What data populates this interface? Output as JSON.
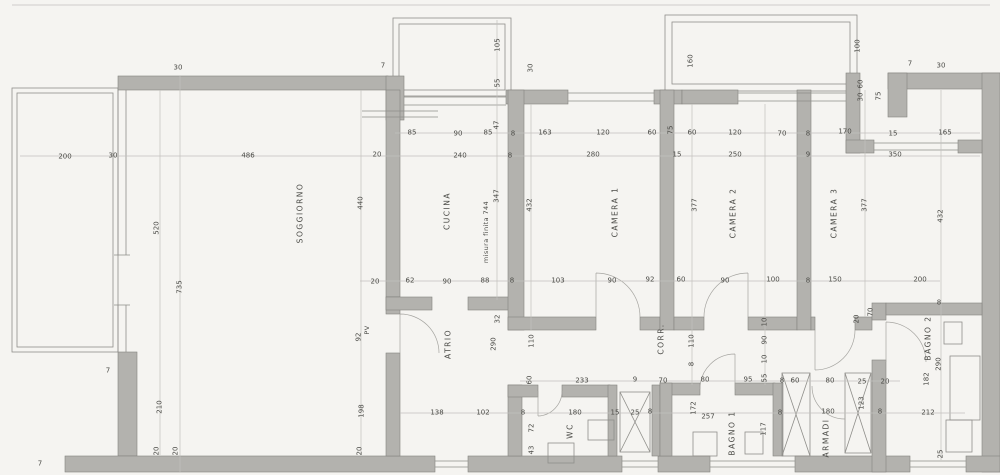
{
  "colors": {
    "paper": "#f5f4f1",
    "wall": "#b3b2ae",
    "line": "#8f8e8a",
    "thin": "#c2c1bd",
    "text": "#4b4b47"
  },
  "rooms": [
    {
      "t": "SOGGIORNO",
      "x": 300,
      "y": 213,
      "r": 1
    },
    {
      "t": "CUCINA",
      "x": 447,
      "y": 211,
      "r": 1
    },
    {
      "t": "CAMERA 1",
      "x": 615,
      "y": 212,
      "r": 1
    },
    {
      "t": "CAMERA 2",
      "x": 733,
      "y": 213,
      "r": 1
    },
    {
      "t": "CAMERA 3",
      "x": 834,
      "y": 213,
      "r": 1
    },
    {
      "t": "ATRIO",
      "x": 448,
      "y": 344,
      "r": 1
    },
    {
      "t": "CORR.",
      "x": 661,
      "y": 339,
      "r": 1
    },
    {
      "t": "WC",
      "x": 570,
      "y": 431,
      "r": 1
    },
    {
      "t": "BAGNO 1",
      "x": 732,
      "y": 433,
      "r": 1
    },
    {
      "t": "ARMADI",
      "x": 826,
      "y": 438,
      "r": 1
    },
    {
      "t": "BAGNO 2",
      "x": 928,
      "y": 338,
      "r": 1
    }
  ],
  "dimensions": [
    {
      "t": "30",
      "x": 178,
      "y": 68
    },
    {
      "t": "7",
      "x": 383,
      "y": 66
    },
    {
      "t": "105",
      "x": 498,
      "y": 45,
      "r": 1
    },
    {
      "t": "55",
      "x": 498,
      "y": 83,
      "r": 1
    },
    {
      "t": "30",
      "x": 531,
      "y": 68,
      "r": 1
    },
    {
      "t": "160",
      "x": 691,
      "y": 61,
      "r": 1
    },
    {
      "t": "100",
      "x": 858,
      "y": 46,
      "r": 1
    },
    {
      "t": "60",
      "x": 861,
      "y": 84,
      "r": 1
    },
    {
      "t": "30",
      "x": 861,
      "y": 97,
      "r": 1
    },
    {
      "t": "75",
      "x": 879,
      "y": 96,
      "r": 1
    },
    {
      "t": "7",
      "x": 910,
      "y": 64
    },
    {
      "t": "30",
      "x": 941,
      "y": 66
    },
    {
      "t": "85",
      "x": 412,
      "y": 133
    },
    {
      "t": "90",
      "x": 458,
      "y": 134
    },
    {
      "t": "85",
      "x": 488,
      "y": 133
    },
    {
      "t": "47",
      "x": 497,
      "y": 125,
      "r": 1
    },
    {
      "t": "8",
      "x": 513,
      "y": 134
    },
    {
      "t": "163",
      "x": 545,
      "y": 133
    },
    {
      "t": "120",
      "x": 603,
      "y": 133
    },
    {
      "t": "60",
      "x": 652,
      "y": 133
    },
    {
      "t": "75",
      "x": 671,
      "y": 130,
      "r": 1
    },
    {
      "t": "60",
      "x": 692,
      "y": 133
    },
    {
      "t": "120",
      "x": 735,
      "y": 133
    },
    {
      "t": "70",
      "x": 782,
      "y": 134
    },
    {
      "t": "8",
      "x": 808,
      "y": 134
    },
    {
      "t": "170",
      "x": 845,
      "y": 132
    },
    {
      "t": "15",
      "x": 893,
      "y": 134
    },
    {
      "t": "165",
      "x": 945,
      "y": 133
    },
    {
      "t": "200",
      "x": 65,
      "y": 157
    },
    {
      "t": "30",
      "x": 113,
      "y": 156
    },
    {
      "t": "486",
      "x": 248,
      "y": 156
    },
    {
      "t": "20",
      "x": 377,
      "y": 155
    },
    {
      "t": "240",
      "x": 460,
      "y": 156
    },
    {
      "t": "8",
      "x": 510,
      "y": 156
    },
    {
      "t": "280",
      "x": 593,
      "y": 155
    },
    {
      "t": "15",
      "x": 677,
      "y": 155
    },
    {
      "t": "250",
      "x": 735,
      "y": 155
    },
    {
      "t": "9",
      "x": 808,
      "y": 155
    },
    {
      "t": "350",
      "x": 895,
      "y": 155
    },
    {
      "t": "520",
      "x": 157,
      "y": 228,
      "r": 1
    },
    {
      "t": "735",
      "x": 180,
      "y": 287,
      "r": 1
    },
    {
      "t": "440",
      "x": 361,
      "y": 203,
      "r": 1
    },
    {
      "t": "210",
      "x": 160,
      "y": 407,
      "r": 1
    },
    {
      "t": "20",
      "x": 157,
      "y": 451,
      "r": 1
    },
    {
      "t": "20",
      "x": 176,
      "y": 451,
      "r": 1
    },
    {
      "t": "7",
      "x": 108,
      "y": 371
    },
    {
      "t": "7",
      "x": 40,
      "y": 464
    },
    {
      "t": "347",
      "x": 497,
      "y": 196,
      "r": 1
    },
    {
      "t": "432",
      "x": 530,
      "y": 205,
      "r": 1
    },
    {
      "t": "377",
      "x": 695,
      "y": 205,
      "r": 1
    },
    {
      "t": "377",
      "x": 865,
      "y": 205,
      "r": 1
    },
    {
      "t": "432",
      "x": 941,
      "y": 216,
      "r": 1
    },
    {
      "t": "20",
      "x": 375,
      "y": 282
    },
    {
      "t": "62",
      "x": 410,
      "y": 281
    },
    {
      "t": "90",
      "x": 447,
      "y": 282
    },
    {
      "t": "88",
      "x": 485,
      "y": 281
    },
    {
      "t": "8",
      "x": 512,
      "y": 281
    },
    {
      "t": "103",
      "x": 558,
      "y": 281
    },
    {
      "t": "90",
      "x": 612,
      "y": 281
    },
    {
      "t": "92",
      "x": 650,
      "y": 280
    },
    {
      "t": "60",
      "x": 681,
      "y": 280
    },
    {
      "t": "90",
      "x": 725,
      "y": 281
    },
    {
      "t": "100",
      "x": 773,
      "y": 280
    },
    {
      "t": "8",
      "x": 808,
      "y": 281
    },
    {
      "t": "150",
      "x": 835,
      "y": 280
    },
    {
      "t": "200",
      "x": 920,
      "y": 280
    },
    {
      "t": "92",
      "x": 359,
      "y": 337,
      "r": 1
    },
    {
      "t": "198",
      "x": 362,
      "y": 411,
      "r": 1
    },
    {
      "t": "20",
      "x": 360,
      "y": 451,
      "r": 1
    },
    {
      "t": "32",
      "x": 498,
      "y": 319,
      "r": 1
    },
    {
      "t": "290",
      "x": 494,
      "y": 344,
      "r": 1
    },
    {
      "t": "110",
      "x": 532,
      "y": 341,
      "r": 1
    },
    {
      "t": "110",
      "x": 692,
      "y": 341,
      "r": 1
    },
    {
      "t": "8",
      "x": 692,
      "y": 364,
      "r": 1
    },
    {
      "t": "10",
      "x": 765,
      "y": 322,
      "r": 1
    },
    {
      "t": "90",
      "x": 765,
      "y": 340,
      "r": 1
    },
    {
      "t": "10",
      "x": 765,
      "y": 359,
      "r": 1
    },
    {
      "t": "20",
      "x": 857,
      "y": 319,
      "r": 1
    },
    {
      "t": "70",
      "x": 871,
      "y": 312,
      "r": 1
    },
    {
      "t": "8",
      "x": 939,
      "y": 303
    },
    {
      "t": "290",
      "x": 939,
      "y": 364,
      "r": 1
    },
    {
      "t": "182",
      "x": 927,
      "y": 379,
      "r": 1
    },
    {
      "t": "60",
      "x": 530,
      "y": 380,
      "r": 1
    },
    {
      "t": "233",
      "x": 582,
      "y": 381
    },
    {
      "t": "9",
      "x": 635,
      "y": 380
    },
    {
      "t": "70",
      "x": 663,
      "y": 381
    },
    {
      "t": "80",
      "x": 705,
      "y": 380
    },
    {
      "t": "95",
      "x": 748,
      "y": 380
    },
    {
      "t": "55",
      "x": 765,
      "y": 378,
      "r": 1
    },
    {
      "t": "8",
      "x": 782,
      "y": 381
    },
    {
      "t": "60",
      "x": 795,
      "y": 381
    },
    {
      "t": "80",
      "x": 830,
      "y": 381
    },
    {
      "t": "25",
      "x": 862,
      "y": 382
    },
    {
      "t": "20",
      "x": 885,
      "y": 382
    },
    {
      "t": "138",
      "x": 437,
      "y": 413
    },
    {
      "t": "102",
      "x": 483,
      "y": 413
    },
    {
      "t": "8",
      "x": 523,
      "y": 413
    },
    {
      "t": "180",
      "x": 575,
      "y": 413
    },
    {
      "t": "15",
      "x": 615,
      "y": 413
    },
    {
      "t": "25",
      "x": 635,
      "y": 413
    },
    {
      "t": "8",
      "x": 650,
      "y": 412
    },
    {
      "t": "72",
      "x": 532,
      "y": 428,
      "r": 1
    },
    {
      "t": "43",
      "x": 532,
      "y": 450,
      "r": 1
    },
    {
      "t": "172",
      "x": 694,
      "y": 408,
      "r": 1
    },
    {
      "t": "257",
      "x": 708,
      "y": 417
    },
    {
      "t": "117",
      "x": 764,
      "y": 429,
      "r": 1
    },
    {
      "t": "8",
      "x": 780,
      "y": 413
    },
    {
      "t": "180",
      "x": 828,
      "y": 412
    },
    {
      "t": "123",
      "x": 862,
      "y": 403,
      "r": 1
    },
    {
      "t": "8",
      "x": 880,
      "y": 412
    },
    {
      "t": "212",
      "x": 928,
      "y": 413
    },
    {
      "t": "25",
      "x": 941,
      "y": 454,
      "r": 1
    }
  ],
  "annotations": [
    {
      "t": "misura finita 744",
      "x": 486,
      "y": 232,
      "r": 1
    },
    {
      "t": "PV",
      "x": 367,
      "y": 330,
      "r": 1
    }
  ]
}
